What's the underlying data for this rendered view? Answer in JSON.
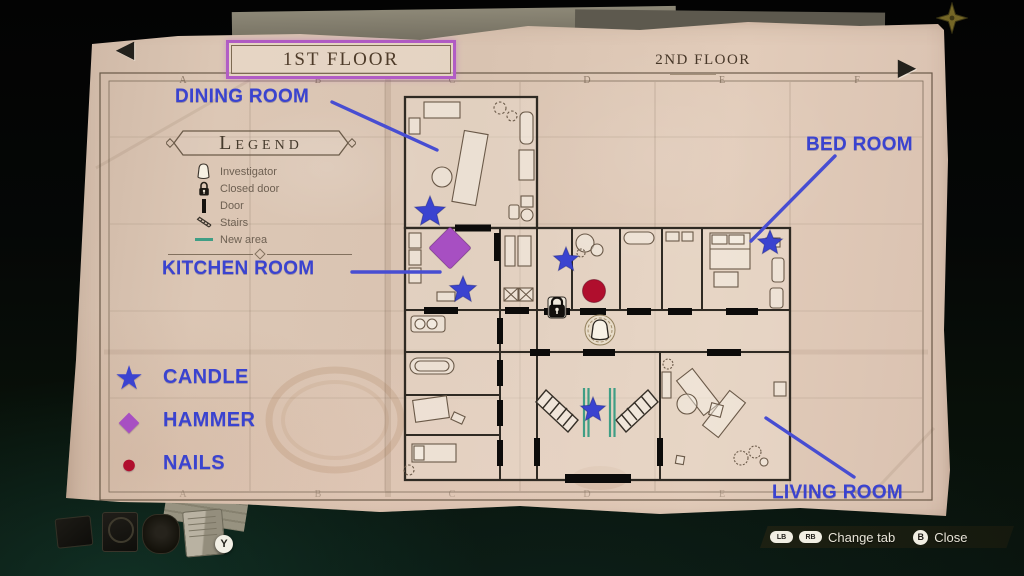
{
  "floor_nav": {
    "selected_floor": "1ST FLOOR",
    "other_floor": "2ND FLOOR",
    "prev_icon": "◀",
    "next_icon": "▶"
  },
  "legend": {
    "title": "Legend",
    "items": [
      {
        "icon": "investigator-icon",
        "label": "Investigator"
      },
      {
        "icon": "closed-door-icon",
        "label": "Closed door"
      },
      {
        "icon": "door-icon",
        "label": "Door"
      },
      {
        "icon": "stairs-icon",
        "label": "Stairs"
      },
      {
        "icon": "new-area-icon",
        "label": "New area"
      }
    ]
  },
  "item_legend": [
    {
      "glyph": "★",
      "label": "CANDLE",
      "color": "#3a43d0"
    },
    {
      "glyph": "◆",
      "label": "HAMMER",
      "color": "#a74fc2"
    },
    {
      "glyph": "●",
      "label": "NAILS",
      "color": "#b00e2d"
    }
  ],
  "room_labels": {
    "dining": "DINING ROOM",
    "bed": "BED ROOM",
    "kitchen": "KITCHEN ROOM",
    "living": "LIVING ROOM"
  },
  "map": {
    "grid_letters": [
      "A",
      "B",
      "C",
      "D",
      "E",
      "F"
    ],
    "markers": [
      {
        "type": "star",
        "x": 430,
        "y": 212,
        "size": 16
      },
      {
        "type": "diamond",
        "x": 450,
        "y": 248,
        "size": 15
      },
      {
        "type": "star",
        "x": 463,
        "y": 290,
        "size": 14
      },
      {
        "type": "star",
        "x": 566,
        "y": 260,
        "size": 13
      },
      {
        "type": "circle",
        "x": 594,
        "y": 291,
        "size": 11.5
      },
      {
        "type": "star",
        "x": 770,
        "y": 243,
        "size": 13
      },
      {
        "type": "star",
        "x": 593,
        "y": 410,
        "size": 13
      },
      {
        "type": "padlock",
        "x": 557,
        "y": 307
      },
      {
        "type": "investigator",
        "x": 600,
        "y": 330
      }
    ]
  },
  "controls": {
    "change_tab_keys": [
      "LB",
      "RB"
    ],
    "change_tab_label": "Change tab",
    "close_key": "B",
    "close_label": "Close",
    "map_item_key": "Y"
  },
  "colors": {
    "candle": "#3a43d0",
    "hammer": "#a74fc2",
    "nails": "#b00e2d",
    "label_blue": "#3a43d0",
    "new_area": "#3f9e85",
    "tab_border": "#b15cc5"
  }
}
